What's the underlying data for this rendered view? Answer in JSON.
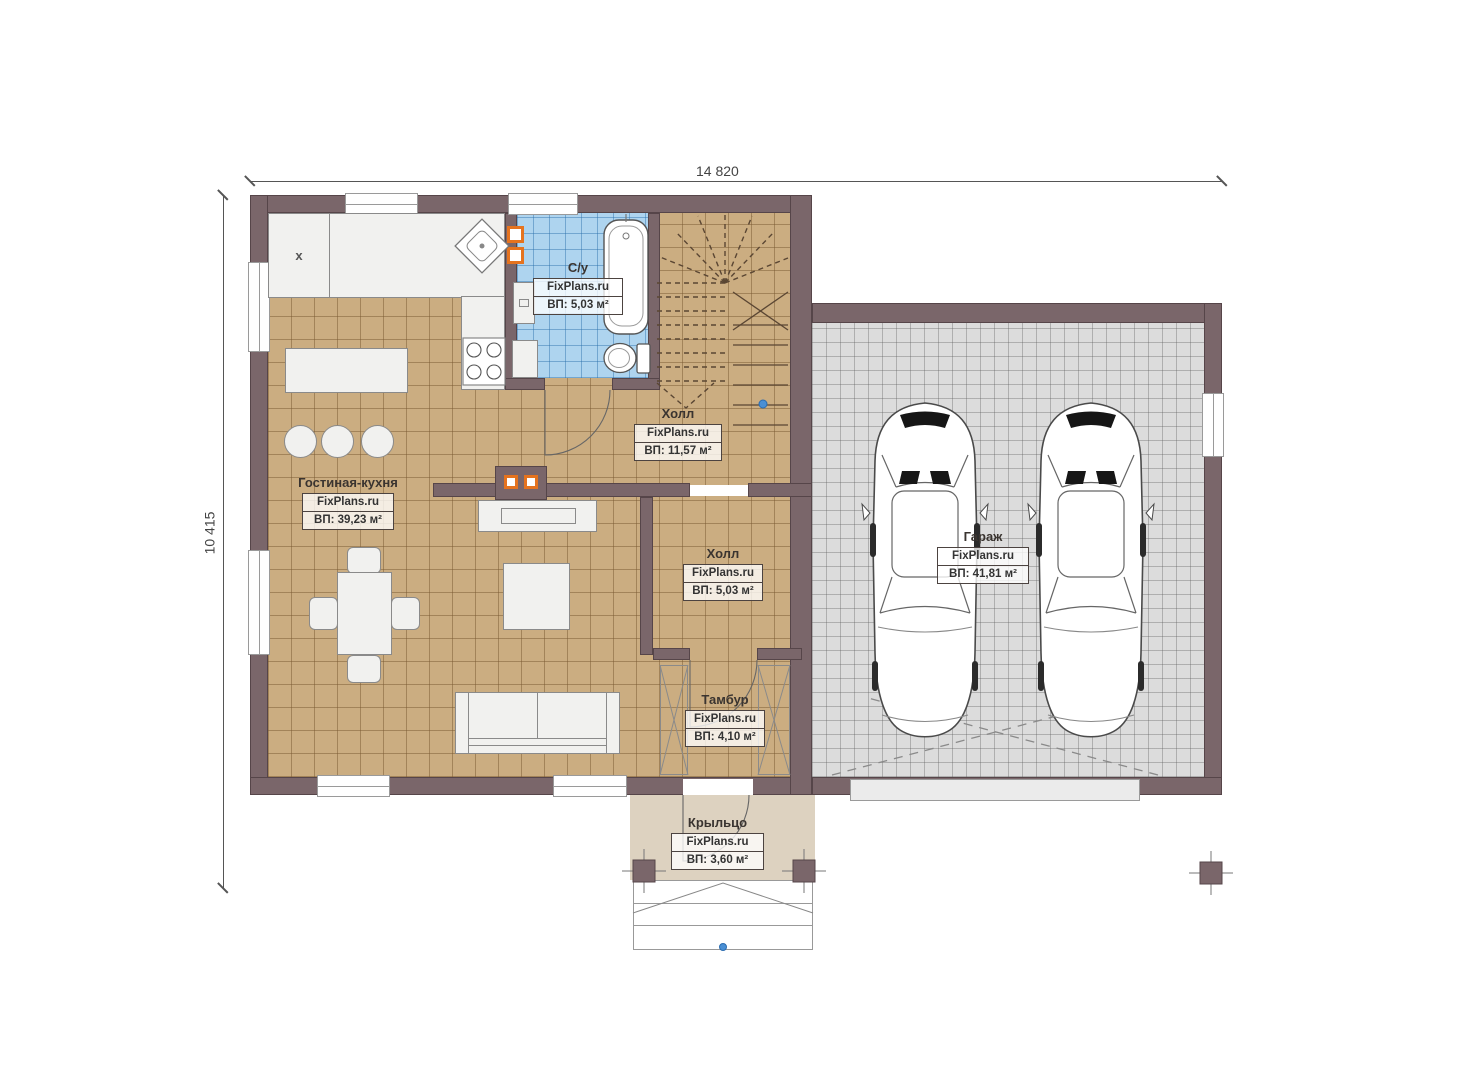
{
  "plan": {
    "dimension_width": "14 820",
    "dimension_height": "10 415"
  },
  "rooms": {
    "bath": {
      "name": "С/у",
      "watermark": "FixPlans.ru",
      "area": "ВП: 5,03 м²"
    },
    "stair_hall": {
      "name": "Холл",
      "watermark": "FixPlans.ru",
      "area": "ВП: 11,57 м²"
    },
    "living": {
      "name": "Гостиная-кухня",
      "watermark": "FixPlans.ru",
      "area": "ВП: 39,23 м²"
    },
    "hall": {
      "name": "Холл",
      "watermark": "FixPlans.ru",
      "area": "ВП: 5,03 м²"
    },
    "tambur": {
      "name": "Тамбур",
      "watermark": "FixPlans.ru",
      "area": "ВП: 4,10 м²"
    },
    "garage": {
      "name": "Гараж",
      "watermark": "FixPlans.ru",
      "area": "ВП: 41,81 м²"
    },
    "porch": {
      "name": "Крыльцо",
      "watermark": "FixPlans.ru",
      "area": "ВП: 3,60 м²"
    }
  },
  "markers": {
    "kitchen_unit": "x"
  },
  "colors": {
    "wall": "#7a666a",
    "wall-edge": "#564549",
    "floor-tan": "#cbad81",
    "floor-garage": "#dcdcdc",
    "floor-bath": "#aed4ef",
    "floor-porch": "#ddd2c0",
    "accent": "#e5731f",
    "marker-blue": "#4a8fd4",
    "furniture": "#f1f1ef"
  }
}
